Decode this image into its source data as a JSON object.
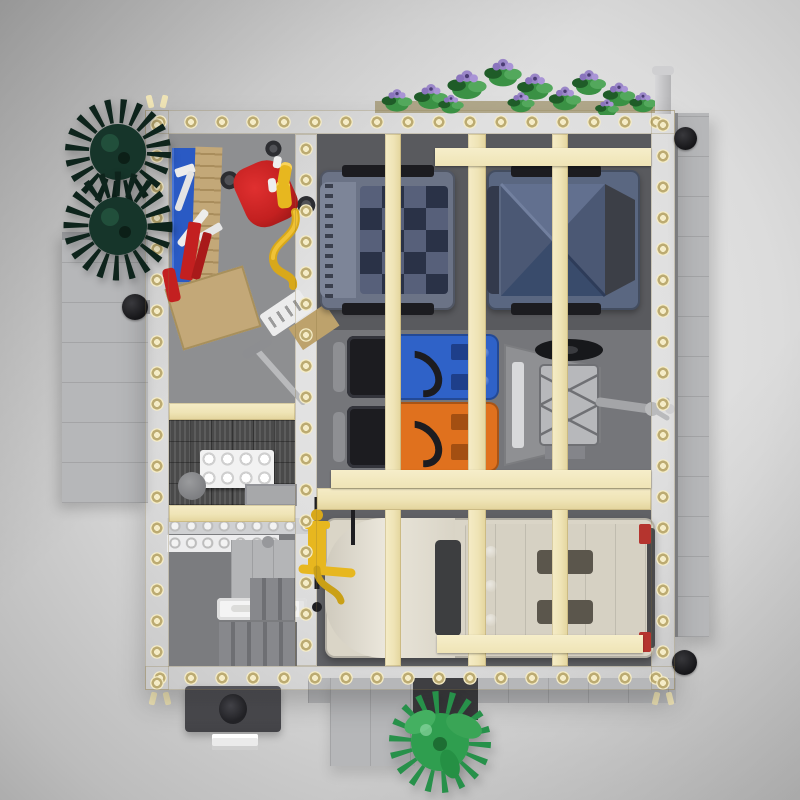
{
  "scene": {
    "title": "Top-down render of a LEGO modular vehicle service garage MOC with tan roof beams, parked trucks, workshop and greenery",
    "style": "3d-product-render",
    "background": "studio gray gradient vignette"
  },
  "colors": {
    "bg_outer": "#bcbcbc",
    "bg_inner": "#e9e9e9",
    "beam": "#efe4b6",
    "beam_hi": "#f5ecc7",
    "beam_lo": "#e3d49c",
    "stud_ring": "#bcab72",
    "floor_workshop": "#8e8f91",
    "floor_garage": "#595a5e",
    "floor_garage_mid": "#75767a",
    "floor_office": "#4a4a4a",
    "wall_gray": "#b6b7b9",
    "truck1_body": "#6b7386",
    "truck_navy": "#2a3247",
    "truck2_body": "#5a6781",
    "tarp_dark": "#394b6b",
    "tarp_mid": "#4b5874",
    "tarp_light": "#62708f",
    "machine_blue": "#2f62c8",
    "machine_orange": "#e0711e",
    "black": "#1c1c20",
    "engine_gray": "#b7b8bb",
    "truckw_body": "#dad5c7",
    "truckw_hood": "#eae6db",
    "windshield": "#3d3e40",
    "taillight_red": "#b5342e",
    "pump_yellow": "#e7b71f",
    "bush_green": "#2f9e4f",
    "bush_leaf": "#44b061",
    "tree_dark": "#16352a",
    "tree_spike": "#0e241c",
    "plant_green": "#3a9144",
    "plant_dark": "#1f5c28",
    "flower_purple": "#9a86c8",
    "red": "#c32020",
    "bench_blue": "#2a5ac4",
    "cardboard": "#c3a878",
    "white": "#f2f2f2",
    "lamp_black": "#17171a"
  },
  "objects": {
    "building": "tan-framed garage roof grid, open top view",
    "conifer_trees": "two dark green spiky conifer trees, upper left exterior",
    "flower_planter_row": "green shrubs with purple flowers along top roof edge",
    "garden_bush": "bright green round bush at bottom exterior",
    "navy_truck_1": "flatbed truck with navy checkered deck, top-left bay",
    "navy_truck_2": "truck with faceted slate-blue tarp cover, top-right bay",
    "blue_utility_vehicle": "blue ride-on machine with black seat and steering wheel",
    "orange_utility_vehicle": "orange ride-on machine with black seat and steering wheel",
    "engine_hoist_trailer": "gray engine hoist on trailer with tow hitch",
    "white_box_truck": "long white box truck in bottom bay, red taillights",
    "floor_jack": "yellow hand pump jack beside white truck",
    "workshop": "left column: blue workbench, tools, red utility cart, cardboard box",
    "office": "dark parquet floor, white stud table, stool, desk",
    "service_counter": "white studded counter rows, cabinets, light bar, staircase",
    "exterior": "gray side walls, chimney vent, black wall lamps, security camera"
  }
}
